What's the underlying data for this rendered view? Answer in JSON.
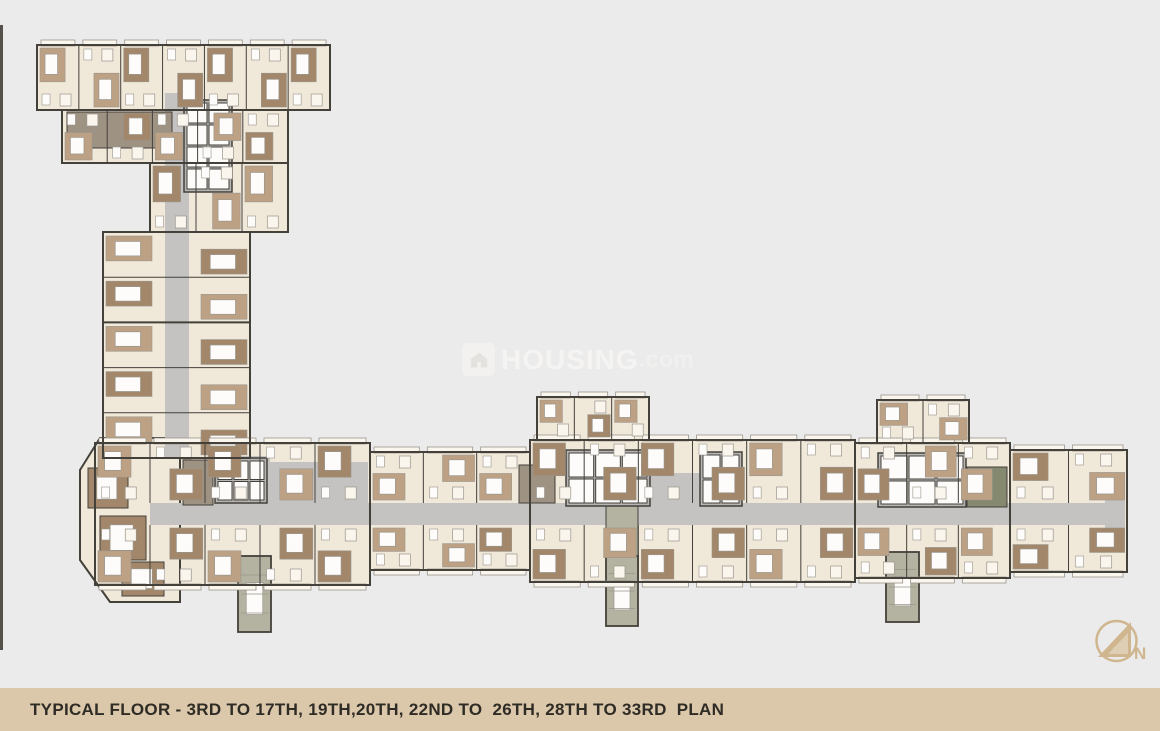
{
  "page": {
    "bg": "#ebebeb"
  },
  "caption": {
    "text": "TYPICAL FLOOR - 3RD TO 17TH, 19TH,20TH, 22ND TO  26TH, 28TH TO 33RD  PLAN"
  },
  "watermark": {
    "brand": "HOUSING",
    "tld": ".com",
    "icon": "house-icon"
  },
  "compass": {
    "label": "N"
  },
  "colors": {
    "bg": "#ebebeb",
    "cream": "#f0e8d9",
    "creamLight": "#faf6ee",
    "brown": "#a3876a",
    "brownLight": "#bda184",
    "taupe": "#9e9283",
    "sage": "#b4b3a1",
    "darkSage": "#84896f",
    "corridor": "#c4c3c1",
    "coreGray": "#b7b6b4",
    "wall": "#44403a",
    "innerLine": "#9a958c",
    "white": "#fdfcfa",
    "tan": "#dbc8ab",
    "tanDark": "#d0b68f",
    "captionText": "#2f2b25",
    "edgeLine": "#55504a"
  },
  "plan": {
    "blocks": [
      {
        "name": "tower-top-bar",
        "x": 37,
        "y": 45,
        "w": 293,
        "h": 65,
        "dir": "h",
        "units": 7,
        "flip": 0,
        "balconyTop": true,
        "balconyBottom": false
      },
      {
        "name": "tower-upper-body",
        "x": 62,
        "y": 110,
        "w": 226,
        "h": 53,
        "dir": "h",
        "units": 5,
        "flip": 1,
        "balconyTop": false,
        "balconyBottom": false
      },
      {
        "name": "tower-mid-body",
        "x": 150,
        "y": 163,
        "w": 138,
        "h": 69,
        "dir": "h",
        "units": 3,
        "flip": 0,
        "balconyTop": false,
        "balconyBottom": false
      },
      {
        "name": "tower-shaft",
        "x": 103,
        "y": 232,
        "w": 147,
        "h": 226,
        "dir": "v",
        "rows": 5
      },
      {
        "name": "wing-module-left",
        "x": 95,
        "y": 443,
        "w": 275,
        "h": 142,
        "dir": "band",
        "units": 5,
        "flip": 0,
        "bands": [
          [
            443,
            60
          ],
          [
            525,
            60
          ]
        ],
        "balconyTop": true,
        "balconyBottom": true
      },
      {
        "name": "wing-module-left2",
        "x": 370,
        "y": 452,
        "w": 160,
        "h": 118,
        "dir": "band",
        "units": 3,
        "flip": 1,
        "bands": [
          [
            452,
            51
          ],
          [
            525,
            45
          ]
        ],
        "balconyTop": true,
        "balconyBottom": true
      },
      {
        "name": "wing-module-center",
        "x": 530,
        "y": 440,
        "w": 325,
        "h": 142,
        "dir": "band",
        "units": 6,
        "flip": 0,
        "bands": [
          [
            440,
            63
          ],
          [
            525,
            57
          ]
        ],
        "balconyTop": true,
        "balconyBottom": true
      },
      {
        "name": "wing-center-top-ext",
        "x": 537,
        "y": 397,
        "w": 112,
        "h": 43,
        "dir": "h",
        "units": 3,
        "flip": 0,
        "balconyTop": true,
        "balconyBottom": false
      },
      {
        "name": "wing-module-right",
        "x": 855,
        "y": 443,
        "w": 155,
        "h": 135,
        "dir": "band",
        "units": 3,
        "flip": 1,
        "bands": [
          [
            443,
            60
          ],
          [
            525,
            53
          ]
        ],
        "balconyTop": true,
        "balconyBottom": true
      },
      {
        "name": "wing-right-top-ext",
        "x": 877,
        "y": 400,
        "w": 92,
        "h": 43,
        "dir": "h",
        "units": 2,
        "flip": 0,
        "balconyTop": true,
        "balconyBottom": false
      },
      {
        "name": "wing-end-module",
        "x": 1010,
        "y": 450,
        "w": 117,
        "h": 122,
        "dir": "band",
        "units": 2,
        "flip": 0,
        "bands": [
          [
            450,
            53
          ],
          [
            525,
            47
          ]
        ],
        "balconyTop": true,
        "balconyBottom": true
      }
    ],
    "polygons": [
      {
        "name": "lower-left-block",
        "points": "100,438 180,438 180,602 110,602 80,560 80,470"
      }
    ],
    "corridors": [
      {
        "name": "tower-corridor",
        "x": 165,
        "y": 93,
        "w": 24,
        "h": 365
      },
      {
        "name": "tower-wing-connector",
        "x": 228,
        "y": 456,
        "w": 42,
        "h": 49
      },
      {
        "name": "wing-corridor",
        "x": 150,
        "y": 503,
        "w": 958,
        "h": 22
      }
    ],
    "lobbies": [
      {
        "x": 268,
        "y": 462,
        "w": 100,
        "h": 42
      },
      {
        "x": 648,
        "y": 473,
        "w": 52,
        "h": 34
      },
      {
        "x": 1105,
        "y": 493,
        "w": 20,
        "h": 38
      }
    ],
    "cores": [
      {
        "name": "tower-lift-core",
        "x": 184,
        "y": 100,
        "w": 48,
        "h": 92,
        "rows": 4,
        "cols": 2
      },
      {
        "name": "left-lift-core",
        "x": 215,
        "y": 458,
        "w": 52,
        "h": 45,
        "rows": 2,
        "cols": 3
      },
      {
        "name": "center-lift-core",
        "x": 566,
        "y": 450,
        "w": 84,
        "h": 56,
        "rows": 2,
        "cols": 3
      },
      {
        "name": "center-lift-core2",
        "x": 700,
        "y": 452,
        "w": 42,
        "h": 54,
        "rows": 2,
        "cols": 2
      },
      {
        "name": "right-lift-core",
        "x": 878,
        "y": 453,
        "w": 88,
        "h": 54,
        "rows": 2,
        "cols": 3
      }
    ],
    "stubs": [
      {
        "name": "refuge-stub-left",
        "x": 238,
        "y": 556,
        "w": 33,
        "h": 76
      },
      {
        "name": "refuge-stub-center",
        "x": 606,
        "y": 556,
        "w": 32,
        "h": 70
      },
      {
        "name": "refuge-stub-right",
        "x": 886,
        "y": 552,
        "w": 33,
        "h": 70
      }
    ],
    "accents": [
      {
        "x": 67,
        "y": 112,
        "w": 105,
        "h": 36,
        "fill": "taupe"
      },
      {
        "x": 183,
        "y": 460,
        "w": 30,
        "h": 45,
        "fill": "taupe"
      },
      {
        "x": 519,
        "y": 465,
        "w": 36,
        "h": 38,
        "fill": "taupe"
      },
      {
        "x": 606,
        "y": 498,
        "w": 32,
        "h": 58,
        "fill": "sage"
      },
      {
        "x": 967,
        "y": 467,
        "w": 40,
        "h": 40,
        "fill": "darkSage"
      },
      {
        "x": 88,
        "y": 468,
        "w": 40,
        "h": 40,
        "fill": "brown",
        "bed": true
      },
      {
        "x": 100,
        "y": 516,
        "w": 46,
        "h": 44,
        "fill": "brown",
        "bed": true
      },
      {
        "x": 122,
        "y": 562,
        "w": 42,
        "h": 34,
        "fill": "brown",
        "bed": true
      }
    ]
  }
}
